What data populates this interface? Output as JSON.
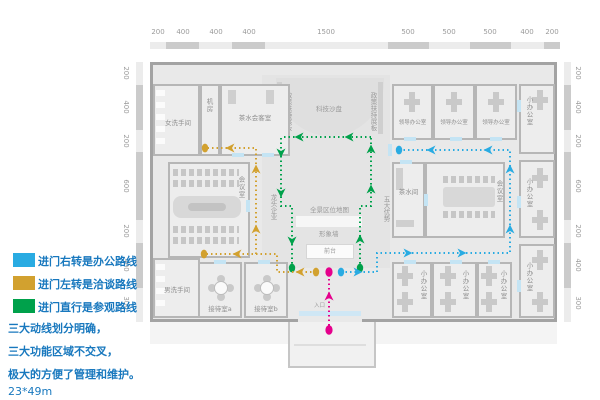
{
  "legend": {
    "items": [
      {
        "color": "#29abe2",
        "label": "进门右转是办公路线"
      },
      {
        "color": "#d2a12f",
        "label": "进门左转是洽谈路线"
      },
      {
        "color": "#00a14b",
        "label": "进门直行是参观路线"
      }
    ]
  },
  "notes": {
    "line1": "三大动线划分明确，",
    "line2": "三大功能区域不交叉，",
    "line3": "极大的方便了管理和维护。",
    "size_label": "23*49m"
  },
  "dimensions": {
    "top": [
      "200",
      "400",
      "400",
      "400",
      "1500",
      "500",
      "500",
      "500",
      "400",
      "200"
    ],
    "left": [
      "200",
      "400",
      "200",
      "600",
      "200",
      "400",
      "300"
    ],
    "right": [
      "200",
      "400",
      "200",
      "600",
      "200",
      "400",
      "300"
    ]
  },
  "rooms": {
    "women_wc": "女洗手间",
    "server_room": "机房",
    "tea_reception": "茶水会客室",
    "conference_left": "会议室",
    "men_wc": "男洗手间",
    "reception_a": "接待室a",
    "reception_b": "接待室b",
    "leader_office_1": "领导办公室",
    "leader_office_2": "领导办公室",
    "leader_office_3": "领导办公室",
    "small_office_right_top": "小办公室",
    "small_office_right_mid": "小办公室",
    "small_office_right_bottom": "小办公室",
    "tea_room": "茶水间",
    "conference_right": "会议室",
    "small_office_1": "小办公室",
    "small_office_2": "小办公室",
    "small_office_3": "小办公室"
  },
  "hall": {
    "sand_table": "科技沙盘",
    "board_left": "政策扶持展板",
    "board_right": "政策扶持展板",
    "leading_firms": "龙头企业",
    "five_advantages": "五大优势",
    "area_map": "全景区位地图",
    "image_wall": "形象墙",
    "front_desk": "前台",
    "entrance": "入口"
  },
  "routes": {
    "office_route_color": "#29abe2",
    "talk_route_color": "#d2a12f",
    "visit_route_color": "#00a14b",
    "entry_route_color": "#e5008c"
  }
}
